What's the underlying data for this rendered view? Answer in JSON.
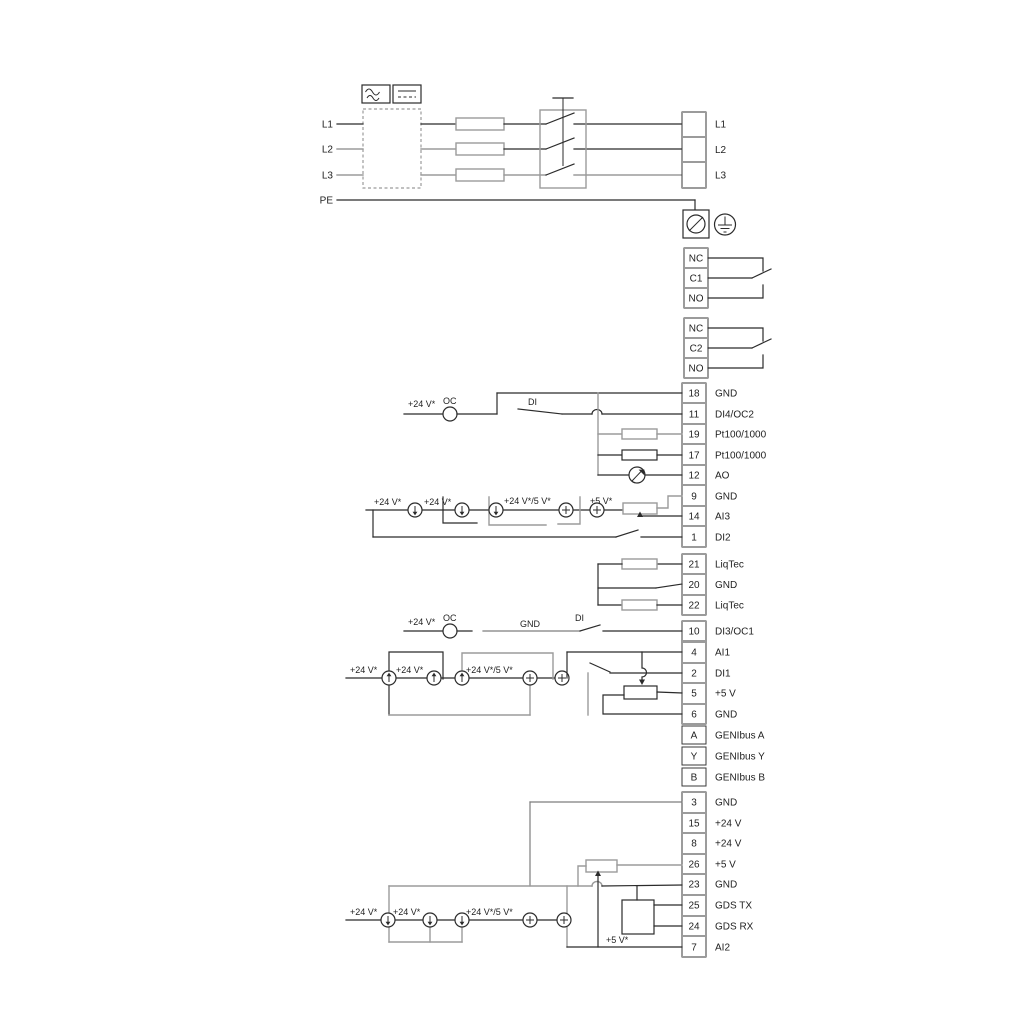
{
  "colors": {
    "wire_dark": "#2b2b2b",
    "wire_gray": "#9b9b9b",
    "text": "#1f1f1f",
    "background": "#ffffff"
  },
  "power": {
    "inputs": [
      "L1",
      "L2",
      "L3",
      "PE"
    ],
    "outputs": [
      "L1",
      "L2",
      "L3"
    ],
    "icons": {
      "ac": "ac-wave-symbol",
      "dc": "dc-line-symbol",
      "filter": "dashed-filter-box",
      "fuse": "fuse",
      "switch": "disconnect-switch",
      "screw": "screw-terminal",
      "earth": "protective-earth"
    }
  },
  "relays": {
    "relay1": [
      "NC",
      "C1",
      "NO"
    ],
    "relay2": [
      "NC",
      "C2",
      "NO"
    ]
  },
  "tg": {
    "a": [
      {
        "n": "18",
        "l": "GND"
      },
      {
        "n": "11",
        "l": "DI4/OC2"
      },
      {
        "n": "19",
        "l": "Pt100/1000"
      },
      {
        "n": "17",
        "l": "Pt100/1000"
      },
      {
        "n": "12",
        "l": "AO"
      },
      {
        "n": "9",
        "l": "GND"
      },
      {
        "n": "14",
        "l": "AI3"
      },
      {
        "n": "1",
        "l": "DI2"
      }
    ],
    "b": [
      {
        "n": "21",
        "l": "LiqTec"
      },
      {
        "n": "20",
        "l": "GND"
      },
      {
        "n": "22",
        "l": "LiqTec"
      }
    ],
    "c": [
      {
        "n": "10",
        "l": "DI3/OC1"
      }
    ],
    "d": [
      {
        "n": "4",
        "l": "AI1"
      },
      {
        "n": "2",
        "l": "DI1"
      },
      {
        "n": "5",
        "l": "+5 V"
      },
      {
        "n": "6",
        "l": "GND"
      },
      {
        "n": "A",
        "l": "GENIbus A"
      },
      {
        "n": "Y",
        "l": "GENIbus Y"
      },
      {
        "n": "B",
        "l": "GENIbus B"
      }
    ],
    "e": [
      {
        "n": "3",
        "l": "GND"
      },
      {
        "n": "15",
        "l": "+24 V"
      },
      {
        "n": "8",
        "l": "+24 V"
      },
      {
        "n": "26",
        "l": "+5 V"
      },
      {
        "n": "23",
        "l": "GND"
      },
      {
        "n": "25",
        "l": "GDS TX"
      },
      {
        "n": "24",
        "l": "GDS RX"
      },
      {
        "n": "7",
        "l": "AI2"
      }
    ]
  },
  "labels": {
    "row11": {
      "v24": "+24 V*",
      "oc": "OC",
      "di": "DI"
    },
    "ai3": {
      "v24a": "+24 V*",
      "v24b": "+24 V*",
      "v245": "+24 V*/5 V*",
      "v5": "+5 V*"
    },
    "row10": {
      "v24": "+24 V*",
      "oc": "OC",
      "gnd": "GND",
      "di": "DI"
    },
    "ai1": {
      "v24a": "+24 V*",
      "v24b": "+24 V*",
      "v245": "+24 V*/5 V*"
    },
    "ai2": {
      "v24a": "+24 V*",
      "v24b": "+24 V*",
      "v245": "+24 V*/5 V*",
      "v5": "+5 V*"
    }
  }
}
